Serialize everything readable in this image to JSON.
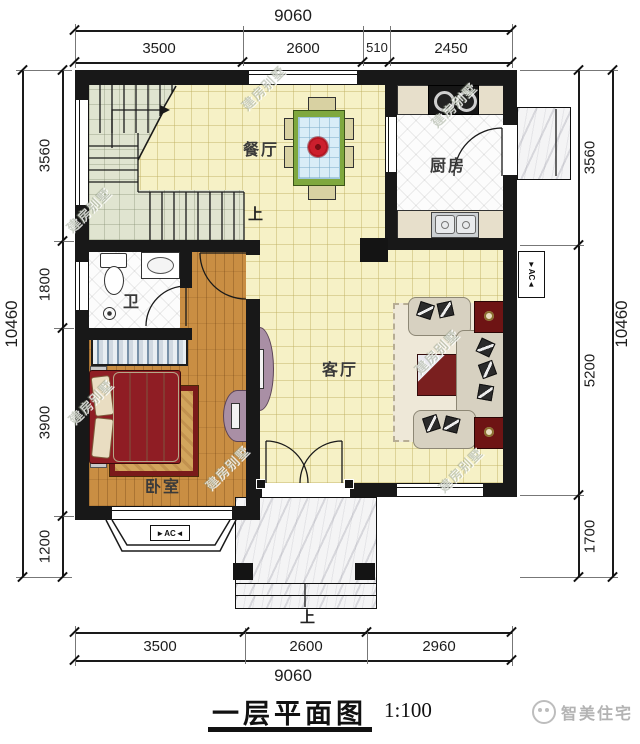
{
  "title_block": {
    "title": "一层平面图",
    "scale": "1:100"
  },
  "brand": {
    "logo_text": "智美住宅"
  },
  "watermark": {
    "text": "建房别墅"
  },
  "rooms": {
    "dining": "餐厅",
    "kitchen": "厨房",
    "bathroom": "卫",
    "living": "客厅",
    "bedroom": "卧室",
    "stairs_up": "上",
    "entry_up": "上"
  },
  "labels": {
    "ac_box": "►AC◄"
  },
  "dimensions": {
    "top": {
      "overall": "9060",
      "segments": [
        "3500",
        "2600",
        "510",
        "2450"
      ]
    },
    "bottom": {
      "overall": "9060",
      "segments": [
        "3500",
        "2600",
        "2960"
      ]
    },
    "left": {
      "overall": "10460",
      "segments": [
        "3560",
        "1800",
        "3900",
        "1200"
      ]
    },
    "right": {
      "overall": "10460",
      "segments": [
        "3560",
        "5200",
        "1700"
      ]
    }
  },
  "colors": {
    "wall": "#181818",
    "floor_tile_yellow": "#f6f1c6",
    "stair_floor": "#e0e4d0",
    "wood_floor": "#c98e43",
    "table_green": "#7fa83e",
    "flower_red": "#cc1f2d",
    "sofa_beige": "#d7d1c1",
    "accent_maroon": "#6e1414"
  }
}
